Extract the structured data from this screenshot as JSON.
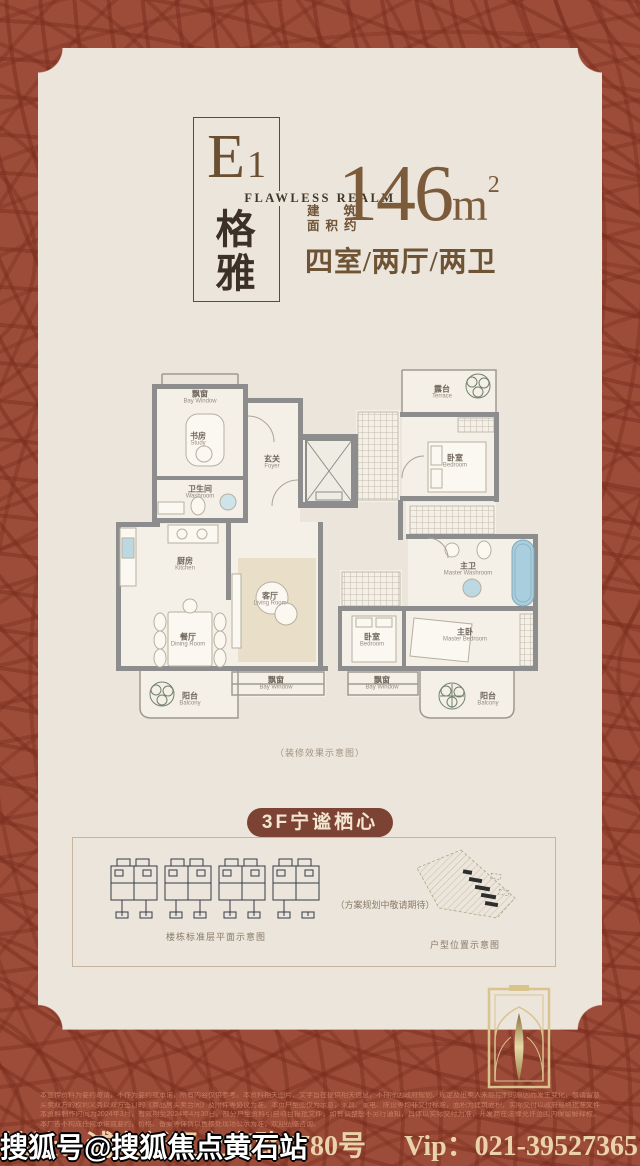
{
  "watermark": "搜狐号@搜狐焦点黄石站",
  "header": {
    "unit_main": "E",
    "unit_sub": "1",
    "tagline": "FLAWLESS REALM",
    "name_top": "格",
    "name_bottom": "雅",
    "area_label_1": "建筑",
    "area_label_2": "面积约",
    "area_num": "146",
    "area_unit": "m",
    "area_sup": "2",
    "layout": "四室/两厅/两卫"
  },
  "floorplan": {
    "caption": "（装修效果示意图）",
    "rooms": [
      {
        "cn": "飘窗",
        "en": "Bay Window"
      },
      {
        "cn": "书房",
        "en": "Study"
      },
      {
        "cn": "玄关",
        "en": "Foyer"
      },
      {
        "cn": "卫生间",
        "en": "Washroom"
      },
      {
        "cn": "露台",
        "en": "Terrace"
      },
      {
        "cn": "卧室",
        "en": "Bedroom"
      },
      {
        "cn": "厨房",
        "en": "Kitchen"
      },
      {
        "cn": "餐厅",
        "en": "Dining Room"
      },
      {
        "cn": "客厅",
        "en": "Living Room"
      },
      {
        "cn": "主卫",
        "en": "Master Washroom"
      },
      {
        "cn": "卧室",
        "en": "Bedroom"
      },
      {
        "cn": "主卧",
        "en": "Master Bedroom"
      },
      {
        "cn": "阳台",
        "en": "Balcony"
      },
      {
        "cn": "飘窗",
        "en": "Bay Window"
      },
      {
        "cn": "飘窗",
        "en": "Bay Window"
      },
      {
        "cn": "阳台",
        "en": "Balcony"
      }
    ]
  },
  "lower": {
    "badge": "3F宁谧栖心",
    "left_caption": "楼栋标准层平面示意图",
    "plan_note": "（方案规划中敬请期待）",
    "right_caption": "户型位置示意图"
  },
  "footer": {
    "disclaimer_lines": [
      "本宣传资料为要约邀请，不作为要约或承诺，所有内容仅供参考。本资料相关图片、文字旨在提供相关信息，不排除因政府规划、规定及出卖人未能控制的原因而发生变化，敬请留意最新资料。",
      "买卖双方的权利义务以双方签订的《商品房买卖合同》及附件等协议为准。本页户型图仅为示意，家具、家电、陈设等均非交付标准，面积为建筑面积，实际交付以政府最终批准文件为准。",
      "本资料制作时间为2024年3月，有效期至2024年4月30日。部分户型资料引自项目报批文件，如有调整恕不另行通知，具体以实际交付为准，开发商在法律允许范围内保留解释权。",
      "本广告不构成任何承诺或要约，价格、备案等详情以售楼处现场公示为准，欢迎莅临咨询。"
    ],
    "address": "地址：浦东新区上南路5780号",
    "vip": "Vip：021-39527365"
  },
  "colors": {
    "background": "#9c4c39",
    "card": "#ebe5db",
    "accent_brown": "#6e5335",
    "badge": "#7c4334",
    "footer_text": "#ead2ab",
    "wall_gray": "#8d8d8d",
    "bathtub_blue": "#a9cedd",
    "emblem_gold": "#d9c48c"
  }
}
